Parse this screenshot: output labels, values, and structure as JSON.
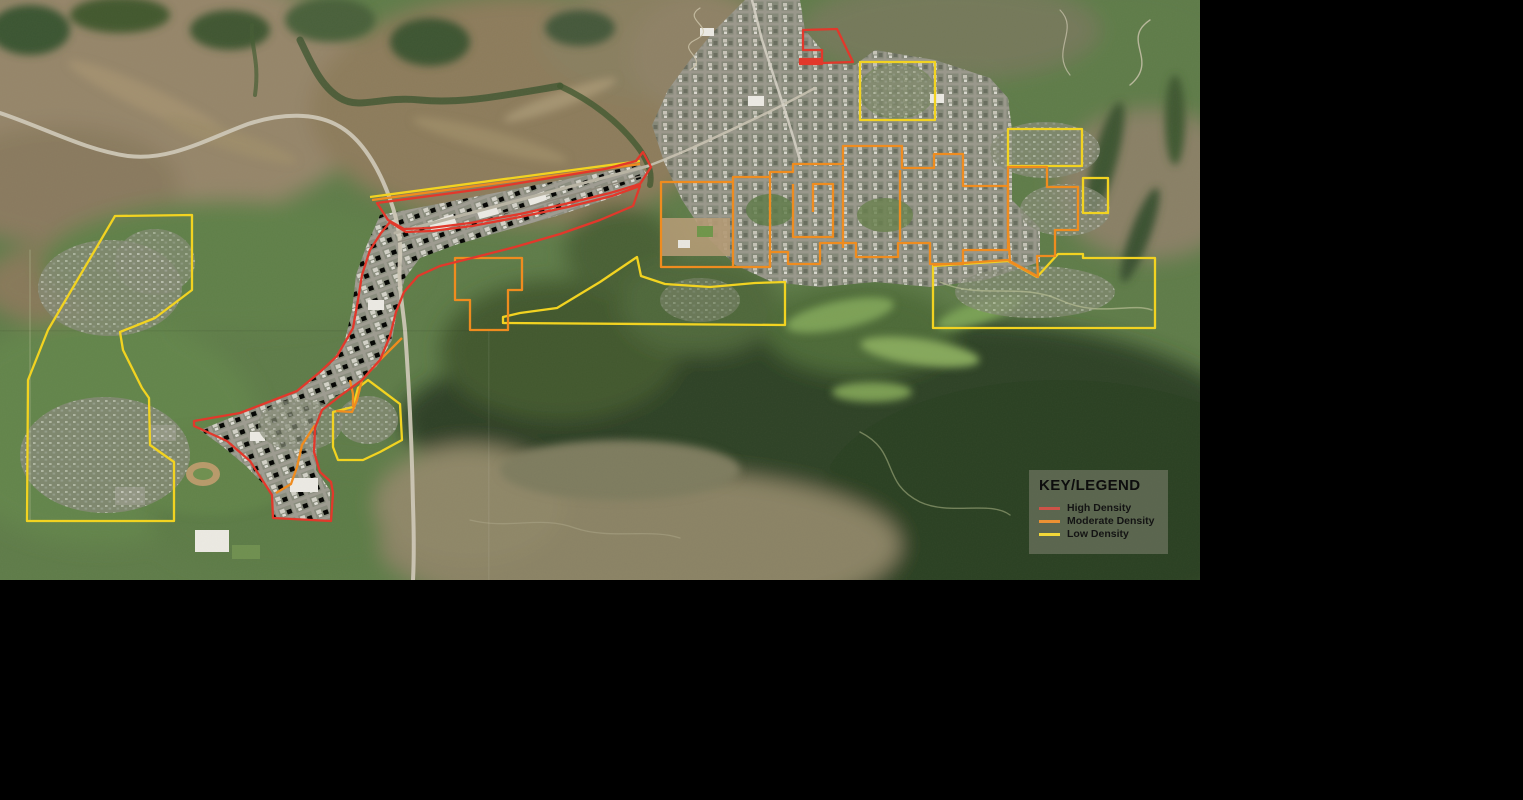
{
  "legend": {
    "title": "KEY/LEGEND",
    "items": [
      {
        "key": "high",
        "label": "High Density",
        "color": "#e2382b",
        "swatch": "#cd5348"
      },
      {
        "key": "moderate",
        "label": "Moderate Density",
        "color": "#ef8c1f",
        "swatch": "#ec9133"
      },
      {
        "key": "low",
        "label": "Low Density",
        "color": "#f2d321",
        "swatch": "#f2d839"
      }
    ]
  },
  "map": {
    "kind": "satellite-aerial",
    "zones": [
      {
        "density": "low",
        "closed": true,
        "points": "115,216 192,215 192,290 155,318 120,332 123,350 142,388 149,398 150,445 174,462 174,521 27,521 28,380 48,330"
      },
      {
        "density": "low",
        "closed": true,
        "points": "860,62 935,62 935,120 860,120"
      },
      {
        "density": "low",
        "closed": true,
        "points": "1008,129 1082,129 1082,166 1008,166"
      },
      {
        "density": "low",
        "closed": true,
        "points": "1083,178 1108,178 1108,213 1083,213"
      },
      {
        "density": "low",
        "closed": true,
        "points": "933,266 1008,261 1037,277 1058,254 1083,254 1083,258 1155,258 1155,328 933,328"
      },
      {
        "density": "low",
        "closed": true,
        "points": "333,412 353,407 358,388 368,380 400,404 402,440 380,452 363,460 338,460 333,447"
      },
      {
        "density": "low",
        "closed": false,
        "points": "370,197 640,161"
      },
      {
        "density": "low",
        "closed": true,
        "points": "637,257 600,282 557,308 520,313 503,317 503,323 785,325 785,282 755,283 710,287 665,284 641,276"
      },
      {
        "density": "moderate",
        "closed": true,
        "points": "661,182 733,182 733,177 770,177 770,172 793,172 793,164 843,164 843,146 902,146 902,168 934,168 934,154 963,154 963,186 1008,186 1008,250 963,250 963,264 930,264 930,243 898,243 898,257 856,257 856,243 820,243 820,264 788,264 788,252 770,252 770,267 661,267"
      },
      {
        "density": "moderate",
        "closed": false,
        "points": "733,182 733,267"
      },
      {
        "density": "moderate",
        "closed": false,
        "points": "770,177 770,267"
      },
      {
        "density": "moderate",
        "closed": false,
        "points": "793,184 793,237 833,237 833,184 813,184 813,212"
      },
      {
        "density": "moderate",
        "closed": false,
        "points": "843,166 843,248"
      },
      {
        "density": "moderate",
        "closed": false,
        "points": "900,170 900,241"
      },
      {
        "density": "moderate",
        "closed": true,
        "points": "455,258 522,258 522,290 508,290 508,330 470,330 470,300 455,300"
      },
      {
        "density": "moderate",
        "closed": false,
        "points": "402,338 380,360 362,380 357,400 352,412 336,411"
      },
      {
        "density": "moderate",
        "closed": false,
        "points": "315,425 302,445 297,467 291,484 276,493"
      },
      {
        "density": "moderate",
        "closed": true,
        "points": "1008,167 1047,167 1047,187 1078,187 1078,230 1055,230 1055,256 1037,256 1038,277 1010,262 1008,230"
      },
      {
        "density": "moderate",
        "closed": false,
        "points": "933,265 1008,260 1037,276"
      },
      {
        "density": "moderate",
        "closed": false,
        "points": "372,200 640,164"
      },
      {
        "density": "moderate",
        "closed": false,
        "points": "350,380 353,394 353,407"
      },
      {
        "density": "high",
        "closed": true,
        "points": "377,203 430,196 490,188 550,178 605,169 636,161 643,152 651,167 640,184 610,193 565,204 520,214 470,223 430,228 404,229 388,220"
      },
      {
        "density": "high",
        "closed": true,
        "points": "390,222 406,232 432,231 472,226 520,217 568,207 612,196 640,186 633,206 600,220 560,234 515,247 472,258 440,266 418,276 404,292 396,312 390,336 380,360 362,380 340,396 322,410 315,428 314,452 320,472 331,482 333,493 331,521 273,518 272,495 250,461 227,441 194,426 194,421 240,413 297,391 320,372 337,356 348,337 353,328 358,300 362,275 370,250 381,233"
      },
      {
        "density": "high",
        "closed": true,
        "points": "803,30 837,29 853,62 822,63 822,50 803,50"
      },
      {
        "density": "high",
        "closed": true,
        "filled": true,
        "points": "800,59 822,59 822,64 800,64"
      }
    ]
  }
}
